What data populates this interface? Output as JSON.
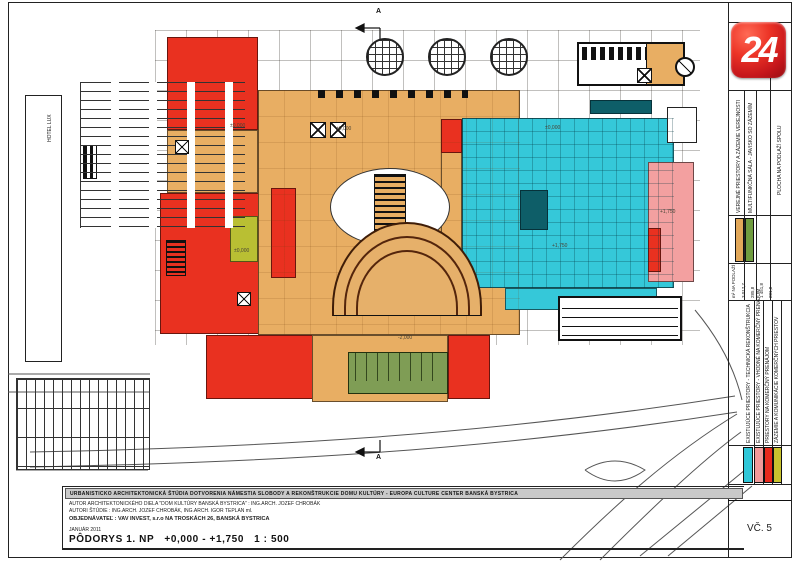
{
  "logo": {
    "text": "24"
  },
  "sheet": {
    "title_bar": "URBANISTICKO ARCHITEKTONICKÁ ŠTÚDIA DOTVORENIA NÁMESTIA SLOBODY A REKONŠTRUKCIE DOMU KULTÚRY - EUROPA CULTURE CENTER BANSKÁ BYSTRICA",
    "author_line1": "AUTOR ARCHITEKTONICKÉHO DIELA \"DOM KULTÚRY BANSKÁ BYSTRICA\" :  ING.ARCH. JOZEF CHROBÁK",
    "author_line2": "AUTORI ŠTÚDIE : ING.ARCH. JOZEF CHROBÁK, ING.ARCH. IGOR TEPLAN ml.",
    "client_line": "OBJEDNÁVATEĽ : VAV INVEST, s.r.o NA TROSKÁCH 26, BANSKÁ BYSTRICA",
    "date_line": "JANUÁR 2011",
    "drawing_title": "PÔDORYS  1. NP",
    "levels": "+0,000 - +1,750",
    "scale": "1 : 500",
    "sheet_number": "VČ. 5"
  },
  "legend": {
    "area_header": "m² NA PODLAŽÍ",
    "area_values": [
      "3 017,7",
      "285,8",
      "1 451,8",
      "281,8"
    ],
    "total_label": "PLOCHA NA PODLAŽÍ SPOLU",
    "total_value": "686,7",
    "rows": [
      {
        "label": "VEREJNÉ PRIESTORY A ZÁZEMIE VEREJNOSTI",
        "color": "#e2a85a"
      },
      {
        "label": "MULTIFUNKČNÁ SÁLA - JAVISKO SO ZÁZEMÍM",
        "color": "#6f9c3f"
      },
      {
        "label": "EXISTUJÚCE PRIESTORY - TECHNICKÁ REKONŠTRUKCIA",
        "color": "#2fc7d8"
      },
      {
        "label": "EXISTUJÚCE PRIESTORY - VHODNÉ NA KOMERČNÝ PRENÁJOM",
        "color": "#f19a9a"
      },
      {
        "label": "PRIESTORY NA KOMERČNÝ PRENÁJOM",
        "color": "#e8291c"
      },
      {
        "label": "ZÁZEMIE A KOMUNIKÁCIE KOMERČNÝCH PRIESTOV",
        "color": "#c9c32e"
      }
    ]
  },
  "plan": {
    "hotel_label": "HOTEL LUX",
    "section_marker": "A",
    "labels": [
      {
        "text": "±0,000",
        "x": 230,
        "y": 124
      },
      {
        "text": "±0,000",
        "x": 336,
        "y": 127
      },
      {
        "text": "±0,000",
        "x": 545,
        "y": 126
      },
      {
        "text": "+1,750",
        "x": 552,
        "y": 244
      },
      {
        "text": "+1,750",
        "x": 660,
        "y": 210
      },
      {
        "text": "±0,000",
        "x": 234,
        "y": 249
      },
      {
        "text": "-2,000",
        "x": 398,
        "y": 336
      }
    ],
    "zones": [
      {
        "name": "red-wing-northwest",
        "x": 167,
        "y": 37,
        "w": 91,
        "h": 93,
        "color": "#e93120"
      },
      {
        "name": "orange-band-west",
        "x": 167,
        "y": 130,
        "w": 91,
        "h": 63,
        "color": "#e8ae63"
      },
      {
        "name": "red-block-west",
        "x": 160,
        "y": 193,
        "w": 100,
        "h": 141,
        "color": "#e93120"
      },
      {
        "name": "concourse-orange",
        "x": 258,
        "y": 90,
        "w": 262,
        "h": 245,
        "color": "#e8ae63"
      },
      {
        "name": "orange-strip-mid",
        "x": 441,
        "y": 152,
        "w": 21,
        "h": 130,
        "color": "#e8ae63"
      },
      {
        "name": "red-escalator-strip",
        "x": 271,
        "y": 188,
        "w": 25,
        "h": 90,
        "color": "#e93120"
      },
      {
        "name": "olive-room",
        "x": 230,
        "y": 216,
        "w": 28,
        "h": 46,
        "color": "#b9bf33"
      },
      {
        "name": "red-block-south-west",
        "x": 206,
        "y": 335,
        "w": 126,
        "h": 64,
        "color": "#e93120"
      },
      {
        "name": "orange-wing-south",
        "x": 312,
        "y": 335,
        "w": 136,
        "h": 67,
        "color": "#e8ae63"
      },
      {
        "name": "red-block-south-east",
        "x": 448,
        "y": 335,
        "w": 42,
        "h": 64,
        "color": "#e93120"
      },
      {
        "name": "cyan-hall",
        "x": 462,
        "y": 118,
        "w": 212,
        "h": 170,
        "color": "#35c8d9"
      },
      {
        "name": "cyan-hall-south",
        "x": 505,
        "y": 288,
        "w": 152,
        "h": 22,
        "color": "#35c8d9"
      },
      {
        "name": "red-block-in-cyan",
        "x": 441,
        "y": 119,
        "w": 21,
        "h": 34,
        "color": "#e93120"
      },
      {
        "name": "pink-wing-east",
        "x": 648,
        "y": 162,
        "w": 46,
        "h": 120,
        "color": "#f3a0a0"
      },
      {
        "name": "red-block-in-pink",
        "x": 648,
        "y": 228,
        "w": 13,
        "h": 44,
        "color": "#e93120"
      },
      {
        "name": "white-annex-in-cyan",
        "x": 667,
        "y": 107,
        "w": 30,
        "h": 36,
        "color": "#ffffff",
        "border": "#222"
      }
    ]
  }
}
